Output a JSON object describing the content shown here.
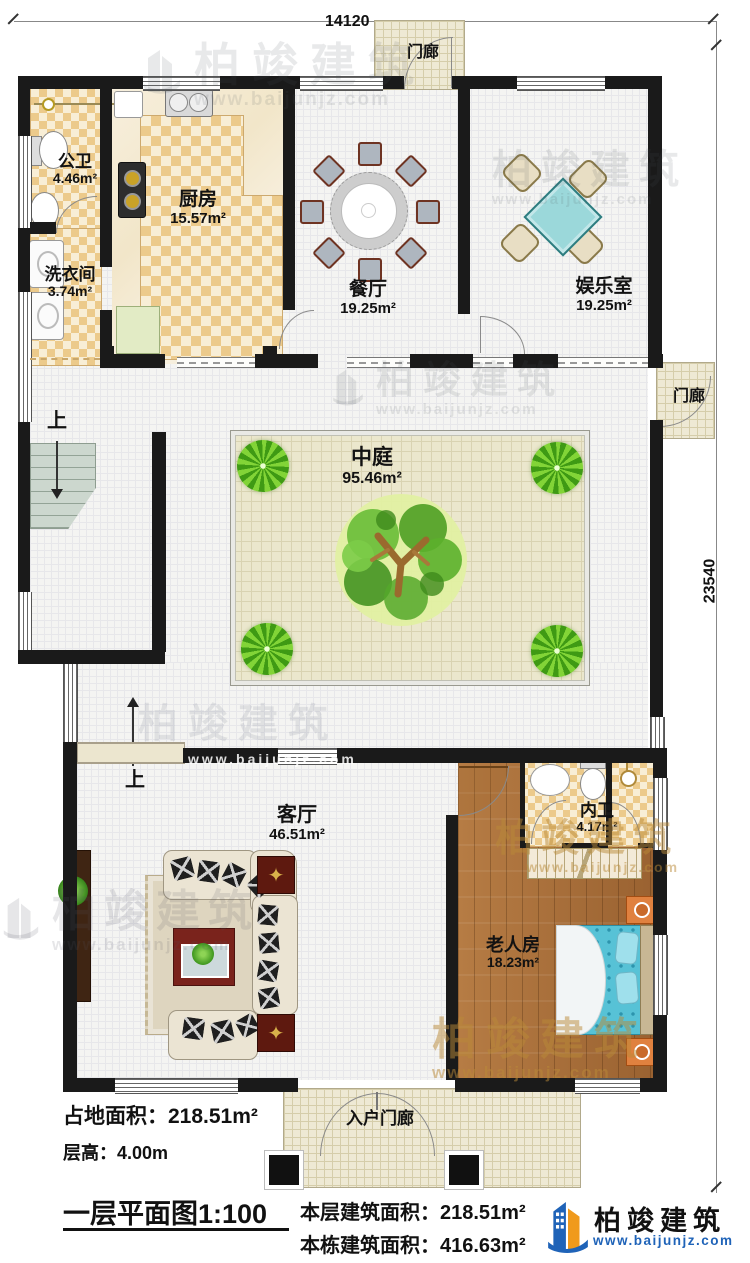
{
  "dimensions": {
    "width_mm": "14120",
    "height_mm": "23540"
  },
  "porch": {
    "top": "门廊",
    "right": "门廊",
    "entry": "入户门廊"
  },
  "stairs": {
    "up1": "上",
    "up2": "上"
  },
  "rooms": {
    "public_bath": {
      "name": "公卫",
      "area": "4.46m²"
    },
    "kitchen": {
      "name": "厨房",
      "area": "15.57m²"
    },
    "laundry": {
      "name": "洗衣间",
      "area": "3.74m²"
    },
    "dining": {
      "name": "餐厅",
      "area": "19.25m²"
    },
    "game": {
      "name": "娱乐室",
      "area": "19.25m²"
    },
    "atrium": {
      "name": "中庭",
      "area": "95.46m²"
    },
    "living": {
      "name": "客厅",
      "area": "46.51m²"
    },
    "inner_bath": {
      "name": "内卫",
      "area": "4.17m²"
    },
    "elder": {
      "name": "老人房",
      "area": "18.23m²"
    }
  },
  "footer": {
    "land_area": "占地面积：218.51m²",
    "floor_height": "层高：4.00m",
    "plan_title": "一层平面图1:100",
    "floor_area": "本层建筑面积：218.51m²",
    "total_area": "本栋建筑面积：416.63m²"
  },
  "brand": {
    "name": "柏竣建筑",
    "url": "www.baijunjz.com"
  },
  "watermark": {
    "name": "柏竣建筑",
    "url": "www.baijunjz.com"
  },
  "icons": {
    "compass_star": "✦"
  },
  "colors": {
    "wall": "#1a1a1a",
    "tile": "#ecca8b",
    "wood": "#ac7340",
    "bed": "#57c2d6",
    "brand_blue": "#1f63b8",
    "brand_orange": "#f09a1c"
  }
}
